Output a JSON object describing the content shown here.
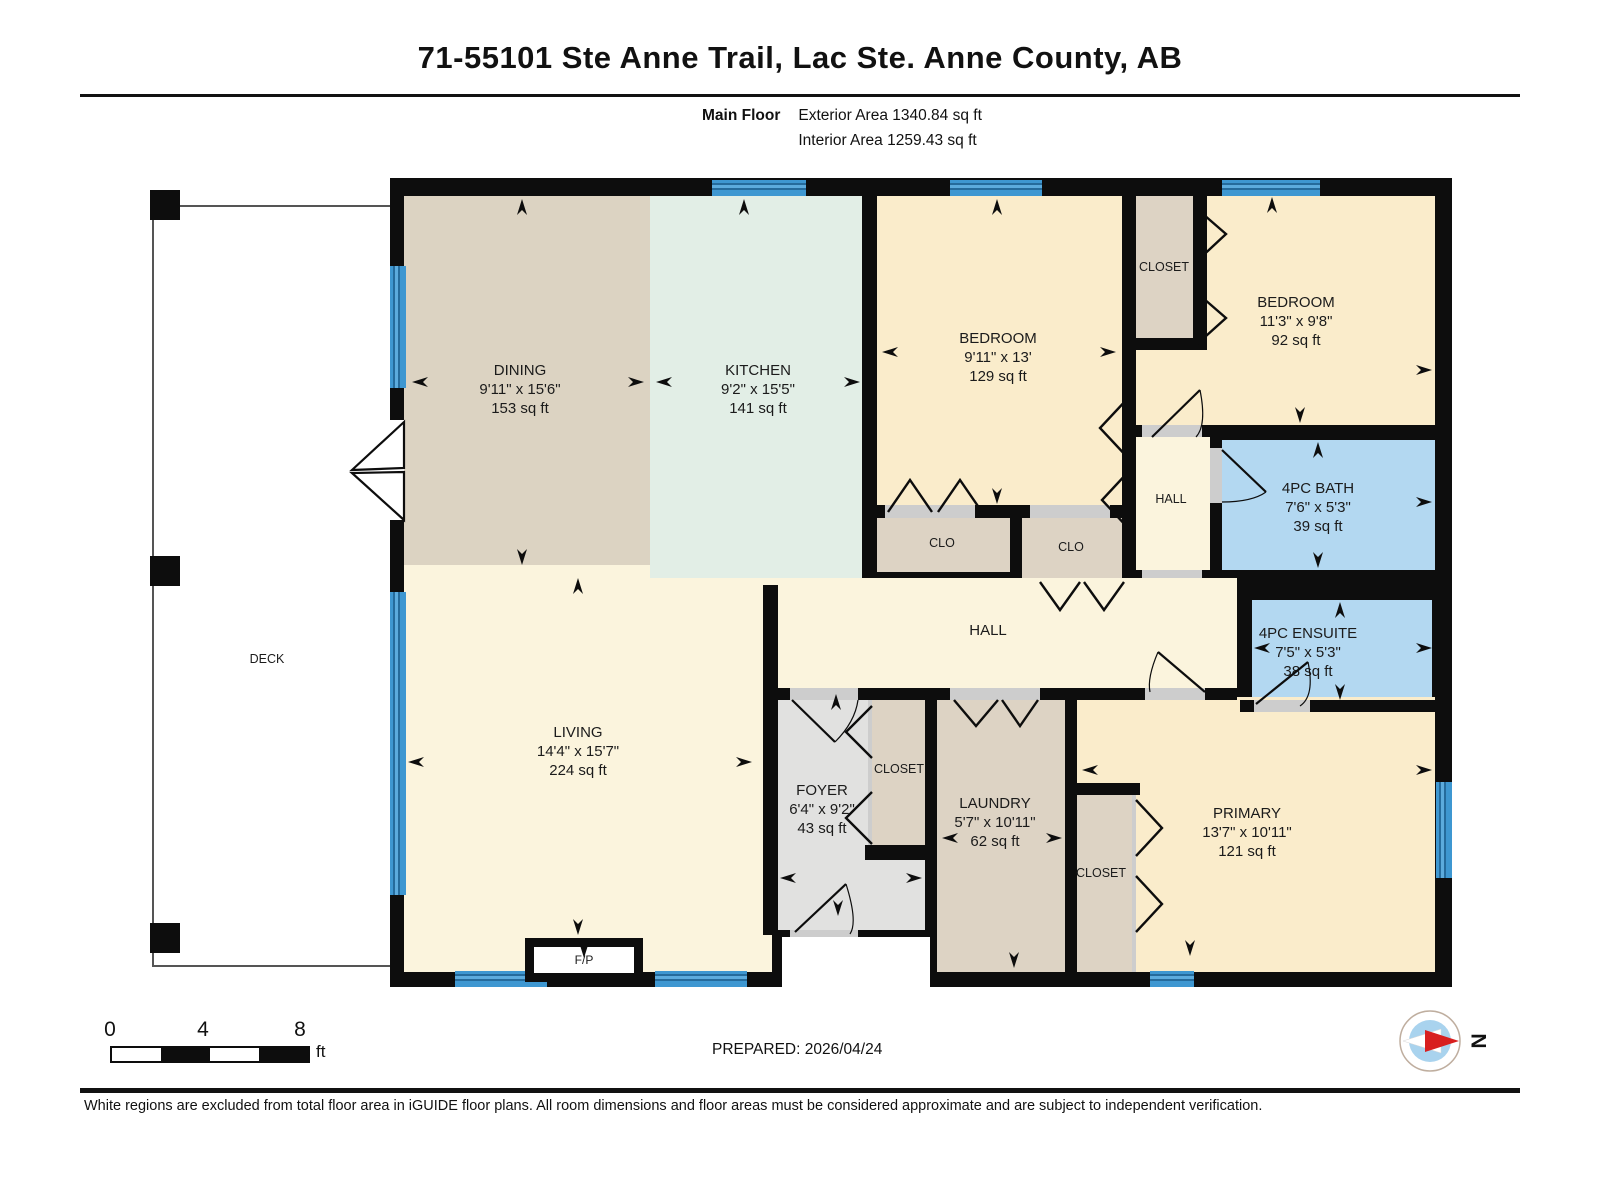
{
  "header": {
    "title": "71-55101 Ste Anne Trail, Lac Ste. Anne County, AB",
    "floor_label": "Main Floor",
    "exterior_area": "Exterior Area 1340.84 sq ft",
    "interior_area": "Interior Area 1259.43 sq ft"
  },
  "rooms": {
    "dining": {
      "name": "DINING",
      "dims": "9'11\" x 15'6\"",
      "area": "153 sq ft"
    },
    "kitchen": {
      "name": "KITCHEN",
      "dims": "9'2\" x 15'5\"",
      "area": "141 sq ft"
    },
    "bedroom1": {
      "name": "BEDROOM",
      "dims": "9'11\" x 13'",
      "area": "129 sq ft"
    },
    "bedroom2": {
      "name": "BEDROOM",
      "dims": "11'3\" x 9'8\"",
      "area": "92 sq ft"
    },
    "bath": {
      "name": "4PC BATH",
      "dims": "7'6\" x 5'3\"",
      "area": "39 sq ft"
    },
    "ensuite": {
      "name": "4PC ENSUITE",
      "dims": "7'5\" x 5'3\"",
      "area": "38 sq ft"
    },
    "living": {
      "name": "LIVING",
      "dims": "14'4\" x 15'7\"",
      "area": "224 sq ft"
    },
    "foyer": {
      "name": "FOYER",
      "dims": "6'4\" x 9'2\"",
      "area": "43 sq ft"
    },
    "laundry": {
      "name": "LAUNDRY",
      "dims": "5'7\" x 10'11\"",
      "area": "62 sq ft"
    },
    "primary": {
      "name": "PRIMARY",
      "dims": "13'7\" x 10'11\"",
      "area": "121 sq ft"
    },
    "hall_small": {
      "name": "HALL"
    },
    "hall_main": {
      "name": "HALL"
    },
    "closet_top": {
      "name": "CLOSET"
    },
    "closet_foyer": {
      "name": "CLOSET"
    },
    "closet_primary": {
      "name": "CLOSET"
    },
    "clo_left": {
      "name": "CLO"
    },
    "clo_right": {
      "name": "CLO"
    },
    "deck": {
      "name": "DECK"
    },
    "fireplace": {
      "name": "F/P"
    }
  },
  "scale_bar": {
    "ticks": [
      "0",
      "4",
      "8"
    ],
    "unit": "ft"
  },
  "compass": {
    "label": "N"
  },
  "footer": {
    "prepared": "PREPARED: 2026/04/24",
    "disclaimer": "White regions are excluded from total floor area in iGUIDE floor plans. All room dimensions and floor areas must be considered approximate and are subject to independent verification."
  },
  "colors": {
    "wall": "#0d0d0d",
    "tan": "#dcd3c2",
    "kitchen_green": "#e2eee6",
    "bedroom_yellow": "#faeccb",
    "hall_cream": "#fbf4dd",
    "foyer_gray": "#e1e1e0",
    "bath_blue": "#b3d8f1",
    "window_blue": "#3e97d1"
  }
}
